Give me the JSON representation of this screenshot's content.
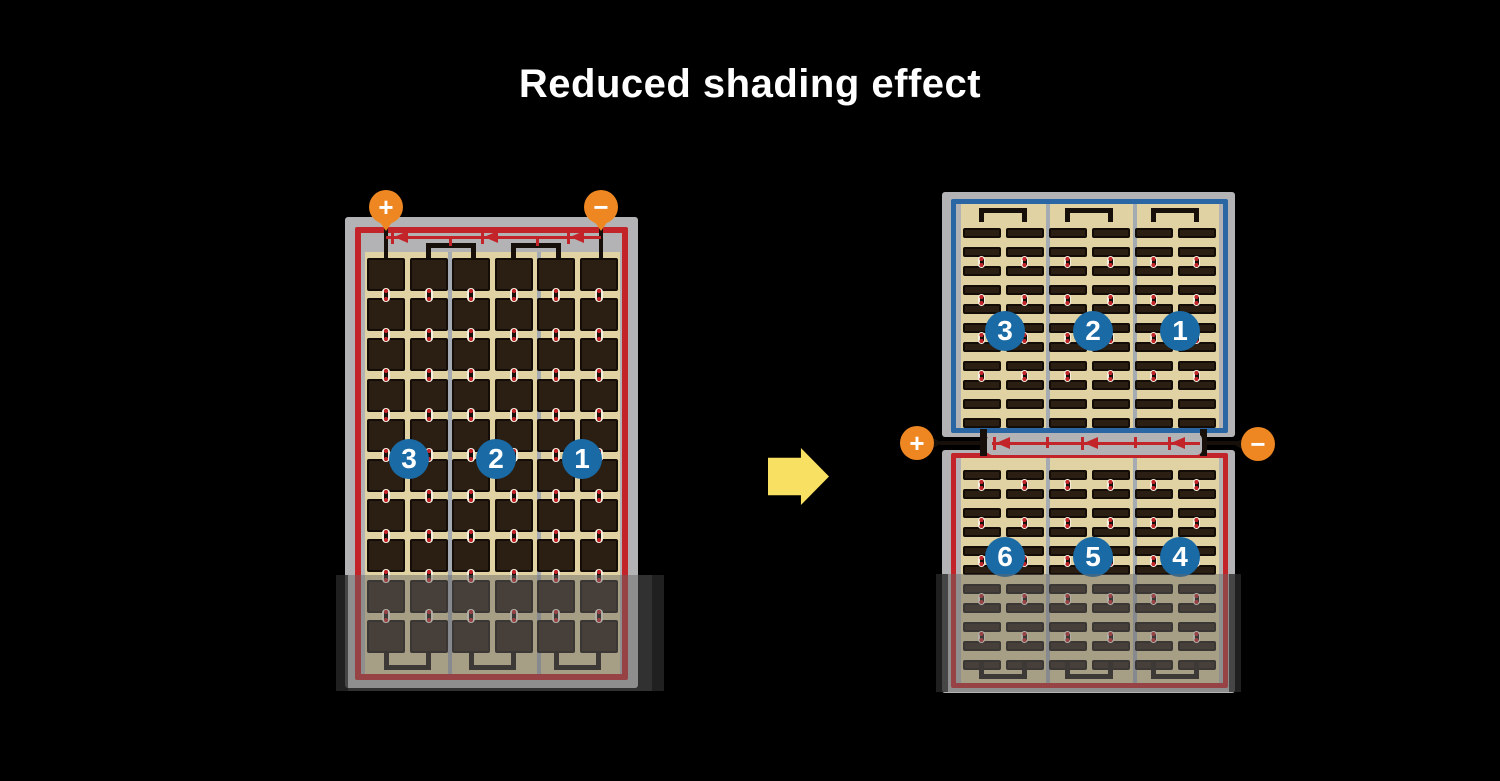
{
  "title": "Reduced shading effect",
  "colors": {
    "background": "#000000",
    "frame_gray": "#b3b3b5",
    "cell_field_tan": "#e0d2a2",
    "cell_dark": "#2b1e13",
    "divider_gray": "#a4abb2",
    "wire_black": "#17100a",
    "string_red": "#c3242a",
    "string_blue": "#2b66a4",
    "badge_blue": "#1a6aa5",
    "terminal_orange": "#ee8722",
    "arrow_yellow": "#f8e062",
    "shade_overlay": "rgba(102,102,102,0.48)",
    "contact_cream": "#f5efdf"
  },
  "before_panel": {
    "terminals": [
      {
        "symbol": "+",
        "position": "top-left"
      },
      {
        "symbol": "−",
        "position": "top-right"
      }
    ],
    "bypass_diodes": 3,
    "badges": [
      "3",
      "2",
      "1"
    ],
    "sections": 3,
    "columns_per_section": 2,
    "rows": 10,
    "cell_style": "full-square",
    "border_color": "#c3242a",
    "shaded_bottom": true
  },
  "after_top_panel": {
    "badges": [
      "3",
      "2",
      "1"
    ],
    "sections": 3,
    "columns_per_section": 2,
    "rows": 11,
    "cell_style": "half-bar",
    "border_color": "#2b66a4",
    "shaded_bottom": false
  },
  "after_bottom_panel": {
    "badges": [
      "6",
      "5",
      "4"
    ],
    "sections": 3,
    "columns_per_section": 2,
    "rows": 11,
    "cell_style": "half-bar",
    "border_color": "#c3242a",
    "shaded_bottom": true
  },
  "junction": {
    "terminals": [
      {
        "symbol": "+",
        "position": "middle-left"
      },
      {
        "symbol": "−",
        "position": "middle-right"
      }
    ],
    "bypass_diodes": 3
  },
  "arrow": {
    "direction": "right"
  }
}
